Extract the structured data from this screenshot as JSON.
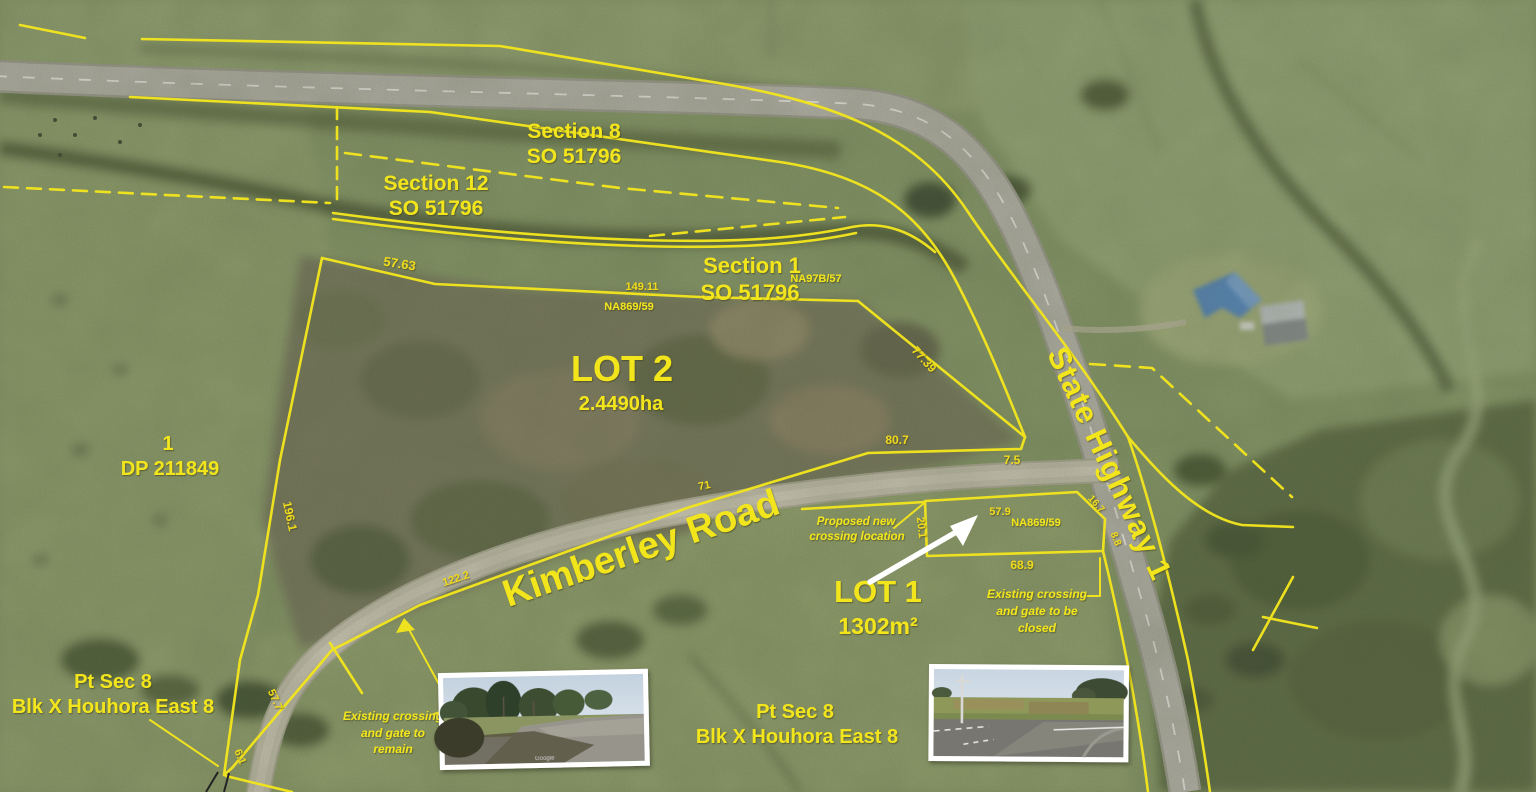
{
  "plan": {
    "parcels": {
      "section8": {
        "name": "Section 8",
        "plan_ref": "SO 51796"
      },
      "section12": {
        "name": "Section 12",
        "plan_ref": "SO 51796"
      },
      "section1": {
        "name": "Section 1",
        "plan_ref": "SO 51796"
      },
      "lot2": {
        "name": "LOT 2",
        "area": "2.4490ha"
      },
      "lot1": {
        "name": "LOT 1",
        "area": "1302m²"
      },
      "neighbour": {
        "lot": "1",
        "plan_ref": "DP 211849"
      },
      "pt_sec8_west": {
        "line1": "Pt Sec 8",
        "line2": "Blk X Houhora East 8"
      },
      "pt_sec8_south": {
        "line1": "Pt Sec 8",
        "line2": "Blk X Houhora East 8"
      }
    },
    "titles": {
      "na97b_57": "NA97B/57",
      "na869_59_boundary": "NA869/59",
      "na869_59_lot1": "NA869/59"
    },
    "roads": {
      "kimberley": "Kimberley Road",
      "state_highway": "State Highway 1"
    },
    "dims": {
      "lot2_north_a": "57.63",
      "lot2_north_b": "149.11",
      "lot2_highway": "77.39",
      "strip_south": "80.7",
      "strip_end": "7.5",
      "road_frontage_a": "71",
      "road_frontage_b": "122.2",
      "lot2_west": "196.1",
      "wedge_side": "57.7",
      "wedge_tip": "6.1",
      "lot1_west": "20.1",
      "lot1_north": "57.9",
      "lot1_south": "68.9",
      "lot1_ne": "16.7",
      "lot1_east": "8.8"
    },
    "notes": {
      "proposed": [
        "Proposed new",
        "crossing location"
      ],
      "remain": [
        "Existing crossing",
        "and gate to",
        "remain"
      ],
      "closed": [
        "Existing crossing",
        "and gate to be",
        "closed"
      ]
    },
    "insets": {
      "credit": "Google"
    },
    "colors": {
      "survey_yellow": "#f2e51e",
      "arrow_white": "#ffffff",
      "highway_surface": "#bcbab1",
      "gravel_surface": "#cdc9b6"
    }
  }
}
